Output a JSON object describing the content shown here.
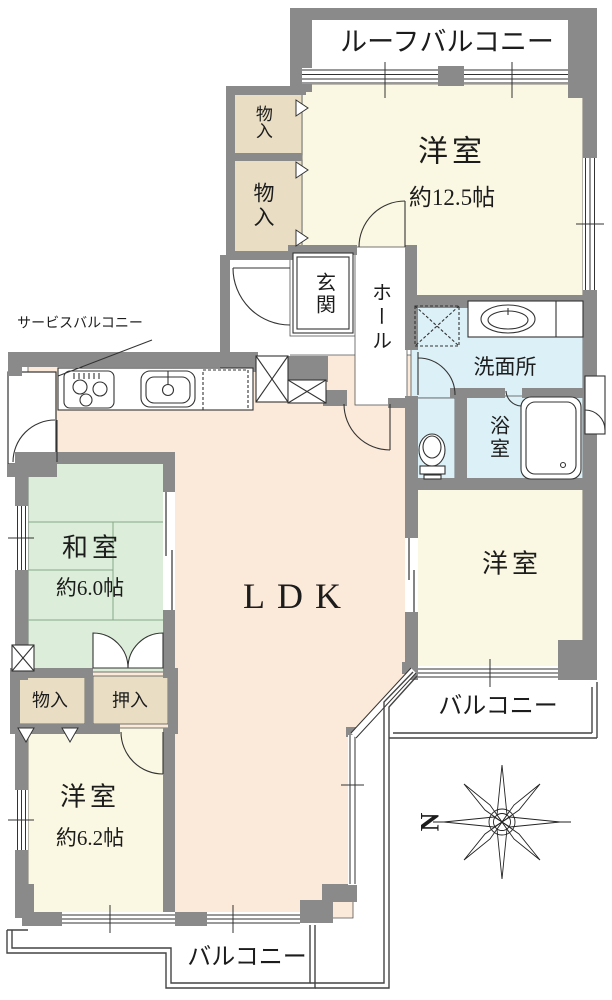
{
  "colors": {
    "wall": "#8a8a8a",
    "outline": "#3a3a3a",
    "western_room_fill": "#faf8e2",
    "ldk_fill": "#fbe9d9",
    "tatami_fill": "#dceeda",
    "wet_area_fill": "#dcf0f7",
    "closet_fill": "#e9dec4",
    "balcony_fill": "#ffffff"
  },
  "rooms": {
    "roof_balcony": {
      "label": "ルーフバルコニー"
    },
    "western_room_125": {
      "label": "洋室",
      "size": "約12.5帖"
    },
    "storage_upper_small": {
      "label": "物入"
    },
    "storage_upper_large": {
      "label": "物入"
    },
    "entrance": {
      "label": "玄関"
    },
    "hall": {
      "label": "ホール"
    },
    "washroom": {
      "label": "洗面所"
    },
    "bathroom": {
      "label": "浴室"
    },
    "service_balcony": {
      "label": "サービスバルコニー"
    },
    "ldk": {
      "label": "LDK"
    },
    "japanese_room": {
      "label": "和室",
      "size": "約6.0帖"
    },
    "closet_monoire": {
      "label": "物入"
    },
    "closet_oshiire": {
      "label": "押入"
    },
    "western_room_62": {
      "label": "洋室",
      "size": "約6.2帖"
    },
    "western_room_right": {
      "label": "洋室"
    },
    "balcony_right": {
      "label": "バルコニー"
    },
    "balcony_bottom": {
      "label": "バルコニー"
    }
  },
  "compass": {
    "north_label": "N"
  }
}
